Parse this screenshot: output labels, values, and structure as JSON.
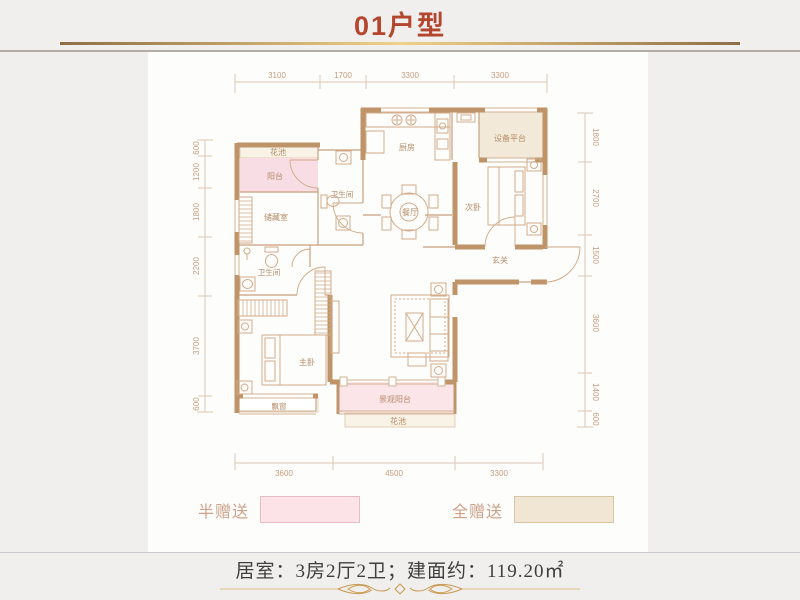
{
  "title": "01户型",
  "plan": {
    "rooms": {
      "flower_top": "花池",
      "balcony": "阳台",
      "storage": "储藏室",
      "bath_upper": "卫生间",
      "kitchen": "厨房",
      "equipment": "设备平台",
      "dining": "餐厅",
      "bedroom2": "次卧",
      "foyer": "玄关",
      "bath_lower": "卫生间",
      "master": "主卧",
      "bay_window": "飘窗",
      "view_balcony": "景观阳台",
      "flower_bottom": "花池"
    },
    "dims": {
      "top": [
        "3100",
        "1700",
        "3300",
        "3300"
      ],
      "bottom": [
        "3600",
        "4500",
        "3300"
      ],
      "left": [
        "600",
        "1200",
        "1800",
        "2200",
        "3700",
        "600"
      ],
      "right": [
        "1800",
        "2700",
        "1500",
        "3600",
        "1400",
        "600"
      ]
    }
  },
  "legend": {
    "half": {
      "label": "半赠送",
      "color": "#fbe3e8"
    },
    "full": {
      "label": "全赠送",
      "color": "#f0e6d3"
    }
  },
  "footer": {
    "info": "居室：3房2厅2卫；建面约：119.20㎡"
  },
  "colors": {
    "background": "#f1efee",
    "title": "#b4452e",
    "gold": "#eed288",
    "wall": "#bf9469",
    "thin_wall": "#c9a07c",
    "dimension": "#c69d7d",
    "balcony_pink": "#f8dee4",
    "view_balcony_pink": "#fbe5e9",
    "equipment_beige": "#f2e9d8",
    "flower_cream": "#f9f3e7"
  }
}
